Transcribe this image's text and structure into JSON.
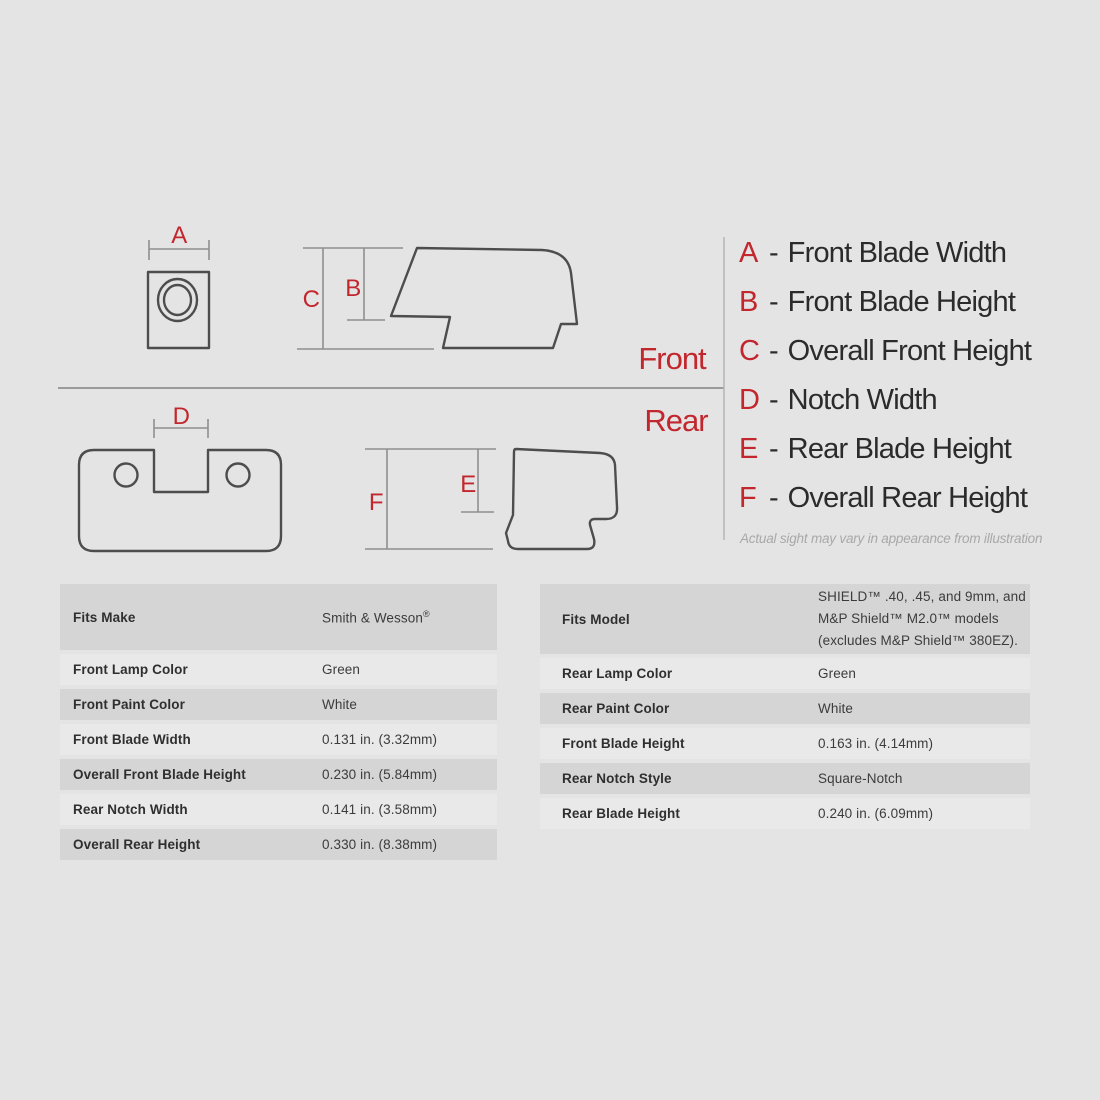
{
  "diagram": {
    "front_label": "Front",
    "rear_label": "Rear",
    "note": "Actual sight may vary in appearance from illustration"
  },
  "legend": {
    "separator": "-",
    "items": [
      {
        "key": "A",
        "label": "Front Blade Width"
      },
      {
        "key": "B",
        "label": "Front Blade Height"
      },
      {
        "key": "C",
        "label": "Overall Front Height"
      },
      {
        "key": "D",
        "label": "Notch Width"
      },
      {
        "key": "E",
        "label": "Rear Blade Height"
      },
      {
        "key": "F",
        "label": "Overall Rear Height"
      }
    ]
  },
  "tables": {
    "left": {
      "rows": [
        {
          "label": "Fits Make",
          "value": "Smith & Wesson",
          "value_sup": "®"
        },
        {
          "label": "Front Lamp Color",
          "value": "Green"
        },
        {
          "label": "Front Paint Color",
          "value": "White"
        },
        {
          "label": "Front Blade Width",
          "value": "0.131 in. (3.32mm)"
        },
        {
          "label": "Overall Front Blade Height",
          "value": "0.230 in. (5.84mm)"
        },
        {
          "label": "Rear Notch Width",
          "value": "0.141 in. (3.58mm)"
        },
        {
          "label": "Overall Rear Height",
          "value": "0.330 in. (8.38mm)"
        }
      ]
    },
    "right": {
      "rows": [
        {
          "label": "Fits Model",
          "value": "SHIELD™ .40, .45, and 9mm, and M&P Shield™ M2.0™ models (excludes M&P Shield™ 380EZ)."
        },
        {
          "label": "Rear Lamp Color",
          "value": "Green"
        },
        {
          "label": "Rear Paint Color",
          "value": "White"
        },
        {
          "label": "Front Blade Height",
          "value": "0.163 in. (4.14mm)"
        },
        {
          "label": "Rear Notch Style",
          "value": "Square-Notch"
        },
        {
          "label": "Rear Blade Height",
          "value": "0.240 in. (6.09mm)"
        }
      ]
    }
  },
  "colors": {
    "accent_red": "#c1272d",
    "outline_gray": "#4d4d4d",
    "dimension_gray": "#8f8f8f",
    "row_dark": "#d6d5d6",
    "row_light": "#eae9ea",
    "background": "#e5e4e5"
  }
}
